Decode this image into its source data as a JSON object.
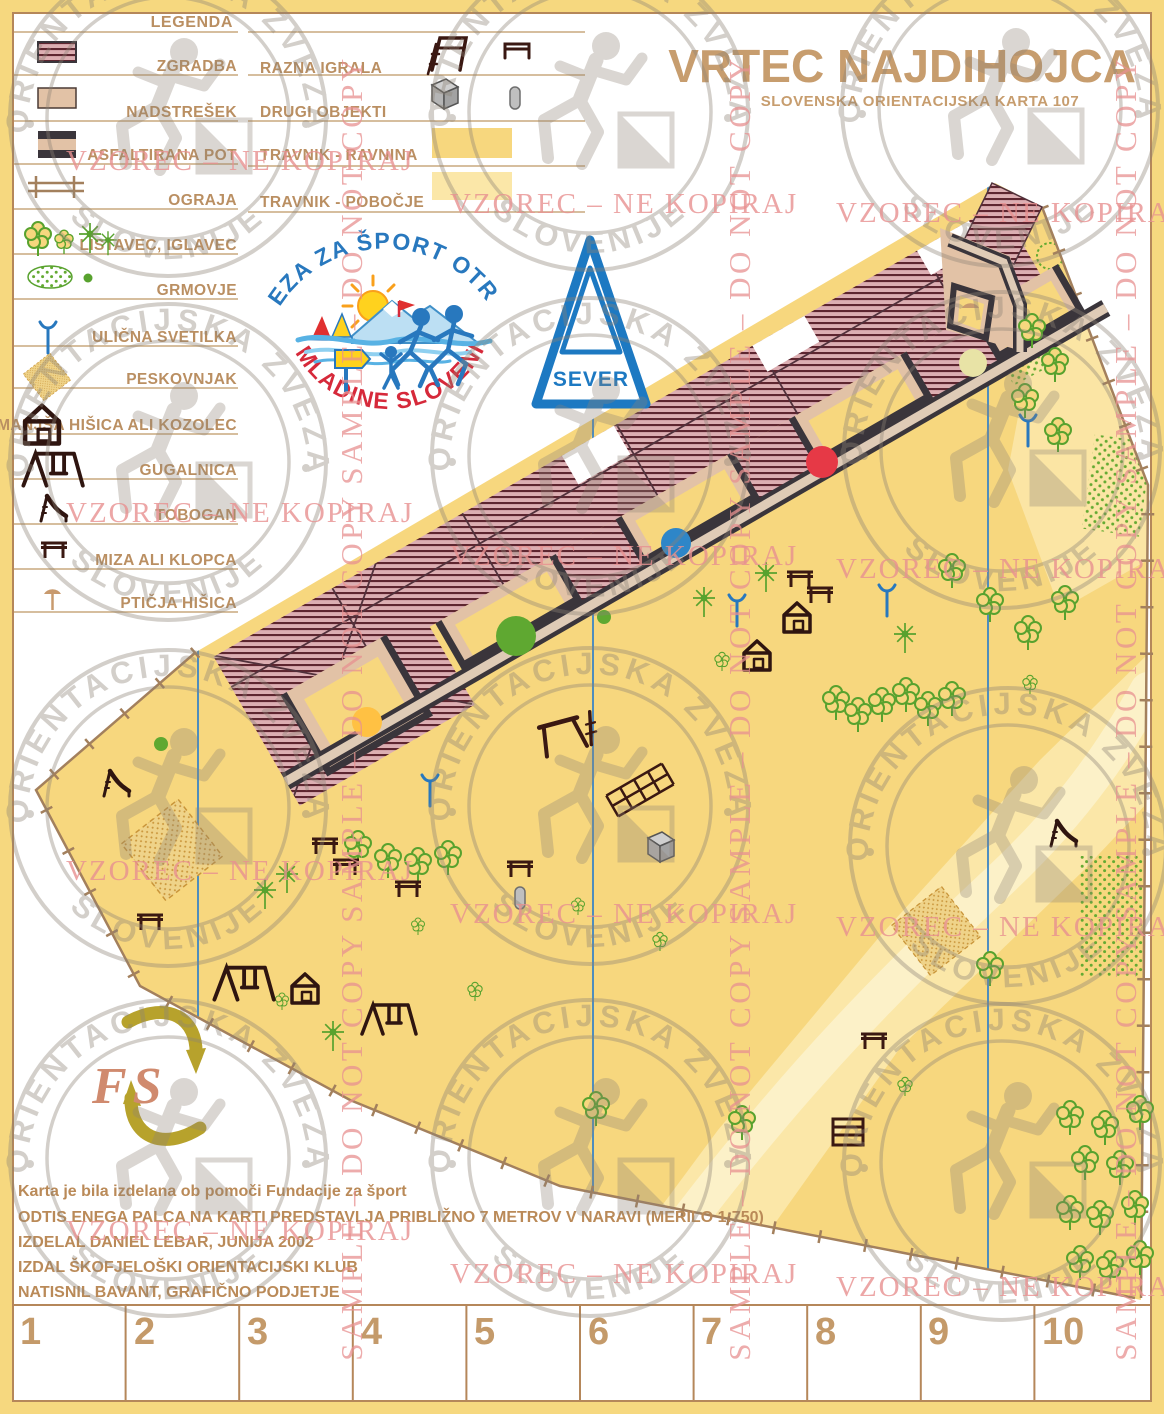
{
  "header": {
    "title": "VRTEC NAJDIHOJCA",
    "subtitle": "SLOVENSKA ORIENTACIJSKA KARTA 107"
  },
  "legend": {
    "heading": "LEGENDA",
    "col1": [
      {
        "symbol": "building-swatch",
        "label": "ZGRADBA"
      },
      {
        "symbol": "canopy-swatch",
        "label": "NADSTREŠEK"
      },
      {
        "symbol": "asphalt-path-swatch",
        "label": "ASFALTIRANA POT"
      },
      {
        "symbol": "fence-symbol",
        "label": "OGRAJA"
      },
      {
        "symbol": "trees-symbol",
        "label": "LISTAVEC, IGLAVEC"
      },
      {
        "symbol": "shrub-symbol",
        "label": "GRMOVJE"
      },
      {
        "symbol": "street-lamp-symbol",
        "label": "ULIČNA SVETILKA"
      },
      {
        "symbol": "sandbox-symbol",
        "label": "PESKOVNJAK"
      },
      {
        "symbol": "small-house-symbol",
        "label": "MANJŠA HIŠICA ALI KOZOLEC"
      },
      {
        "symbol": "swing-symbol",
        "label": "GUGALNICA"
      },
      {
        "symbol": "slide-symbol",
        "label": "TOBOGAN"
      },
      {
        "symbol": "table-symbol",
        "label": "MIZA ALI KLOPCA"
      },
      {
        "symbol": "birdhouse-symbol",
        "label": "PTIČJA HIŠICA"
      }
    ],
    "col2": [
      {
        "symbol": "play-equipment-symbol",
        "label": "RAZNA IGRALA"
      },
      {
        "symbol": "other-objects-symbol",
        "label": "DRUGI OBJEKTI"
      },
      {
        "symbol": "meadow-flat-swatch",
        "label": "TRAVNIK - RAVNINA"
      },
      {
        "symbol": "meadow-slope-swatch",
        "label": "TRAVNIK - POBOČJE"
      }
    ]
  },
  "north": {
    "label": "SEVER"
  },
  "org_logo": {
    "arc_top": "ZVEZA ZA ŠPORT OTROK",
    "arc_bottom": "IN MLADINE SLOVENIJE"
  },
  "fs_logo": {
    "text": "FS"
  },
  "watermark": {
    "notice": "VZOREC – NE KOPIRAJ",
    "sample": "SAMPLE – DO NOT COPY",
    "stamp_top": "ORIENTACIJSKA ZVEZA",
    "stamp_bottom": "SLOVENIJE"
  },
  "credits": {
    "line1": "Karta je bila izdelana ob pomoči Fundacije za šport",
    "line2": "ODTIS ENEGA PALCA NA KARTI PREDSTAVLJA PRIBLIŽNO 7 METROV V NARAVI (MERILO 1:750)",
    "line3": "IZDELAL DANIEL LEBAR, JUNIJA 2002",
    "line4": "IZDAL ŠKOFJELOŠKI ORIENTACIJSKI KLUB",
    "line5": "NATISNIL BAVANT, GRAFIČNO PODJETJE"
  },
  "ruler": {
    "numbers": [
      "1",
      "2",
      "3",
      "4",
      "5",
      "6",
      "7",
      "8",
      "9",
      "10"
    ]
  },
  "colors": {
    "page_border": "#F6D87F",
    "map_meadow": "#F7D77E",
    "map_meadow_light": "#FBE7A8",
    "building_fill": "#DCAEB2",
    "building_stripe": "#5E2630",
    "canopy": "#E2C2A6",
    "path_dark": "#3A353B",
    "fence_brown": "#A3805D",
    "vegetation_green": "#58A22E",
    "feature_blue": "#2878BE",
    "title_tan": "#C79D6E",
    "watermark_pink": "#E89191",
    "control_red": "#E63946",
    "control_blue": "#2E86C8",
    "control_orange": "#FFC143"
  }
}
